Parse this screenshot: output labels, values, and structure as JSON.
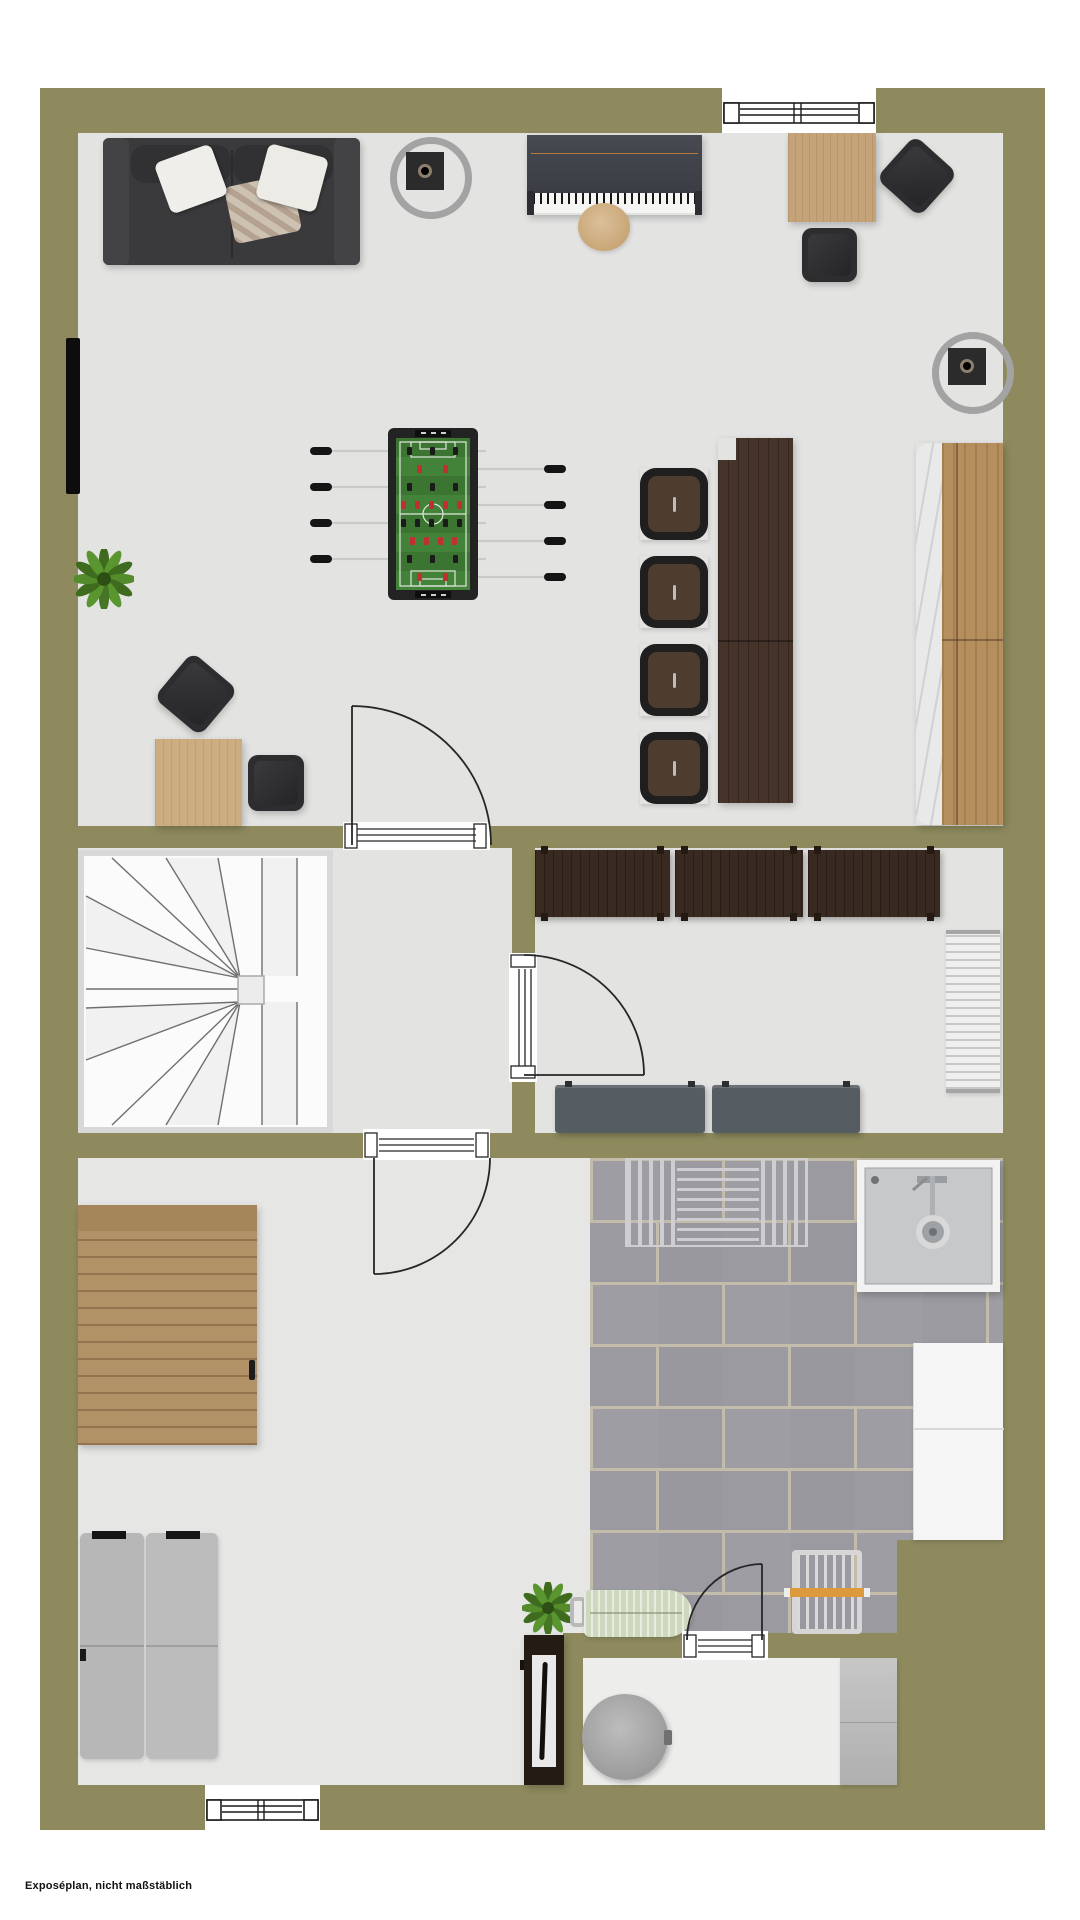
{
  "footer": {
    "text": "Exposéplan, nicht maßstäblich"
  },
  "palette": {
    "wall": "#8e8a5e",
    "floorA": "#e3e3e2",
    "floorB": "#e6e6e5",
    "floorC": "#ededec",
    "tile": "#9a9aa0",
    "grout": "#c3bcab",
    "wood": "#c3a377",
    "woodDark": "#46342b",
    "sideboard": "#382a20",
    "sofa": "#3a3a3c",
    "bench": "#565d62",
    "orange": "#dc9a3d",
    "green": "#3b7531",
    "marble": "#e9e9ea",
    "line": "#262626"
  }
}
